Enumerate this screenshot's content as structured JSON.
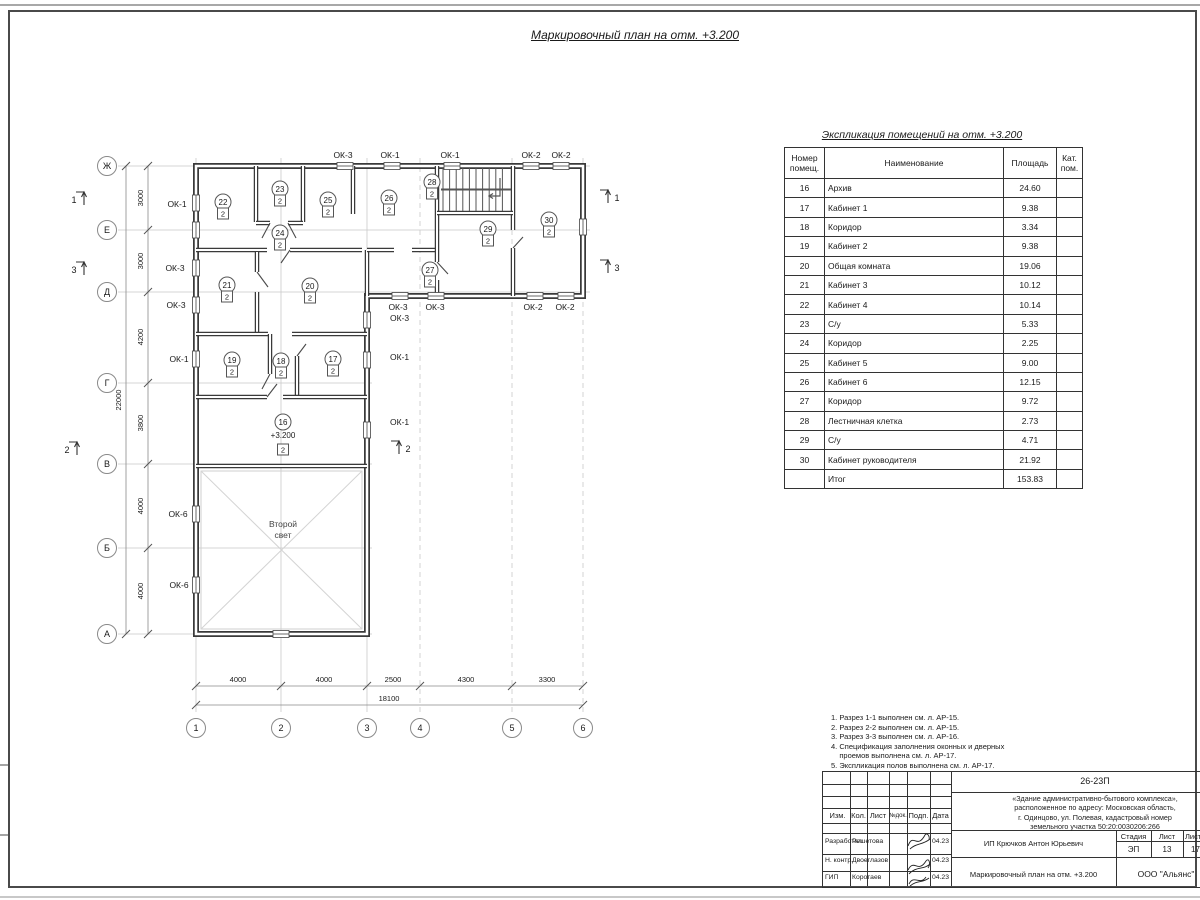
{
  "page": {
    "title": "Маркировочный план на отм. +3.200"
  },
  "schedule": {
    "title": "Экспликация помещений на отм. +3.200",
    "col_num": "Номер\nпомещ.",
    "col_name": "Наименование",
    "col_area": "Площадь",
    "col_cat": "Кат.\nпом.",
    "rows": [
      {
        "num": "16",
        "name": "Архив",
        "area": "24.60",
        "cat": ""
      },
      {
        "num": "17",
        "name": "Кабинет 1",
        "area": "9.38",
        "cat": ""
      },
      {
        "num": "18",
        "name": "Коридор",
        "area": "3.34",
        "cat": ""
      },
      {
        "num": "19",
        "name": "Кабинет 2",
        "area": "9.38",
        "cat": ""
      },
      {
        "num": "20",
        "name": "Общая комната",
        "area": "19.06",
        "cat": ""
      },
      {
        "num": "21",
        "name": "Кабинет 3",
        "area": "10.12",
        "cat": ""
      },
      {
        "num": "22",
        "name": "Кабинет 4",
        "area": "10.14",
        "cat": ""
      },
      {
        "num": "23",
        "name": "С/у",
        "area": "5.33",
        "cat": ""
      },
      {
        "num": "24",
        "name": "Коридор",
        "area": "2.25",
        "cat": ""
      },
      {
        "num": "25",
        "name": "Кабинет 5",
        "area": "9.00",
        "cat": ""
      },
      {
        "num": "26",
        "name": "Кабинет 6",
        "area": "12.15",
        "cat": ""
      },
      {
        "num": "27",
        "name": "Коридор",
        "area": "9.72",
        "cat": ""
      },
      {
        "num": "28",
        "name": "Лестничная клетка",
        "area": "2.73",
        "cat": ""
      },
      {
        "num": "29",
        "name": "С/у",
        "area": "4.71",
        "cat": ""
      },
      {
        "num": "30",
        "name": "Кабинет руководителя",
        "area": "21.92",
        "cat": ""
      }
    ],
    "total_label": "Итог",
    "total_area": "153.83"
  },
  "plan": {
    "elevation": "+3.200",
    "unit_mark": "2",
    "second_light": [
      "Второй",
      "свет"
    ],
    "axes_rows": [
      {
        "l": "Ж",
        "y": 166,
        "ext": 590
      },
      {
        "l": "Е",
        "y": 230,
        "ext": 590
      },
      {
        "l": "Д",
        "y": 292,
        "ext": 590
      },
      {
        "l": "Г",
        "y": 383,
        "ext": 372
      },
      {
        "l": "В",
        "y": 464,
        "ext": 372
      },
      {
        "l": "Б",
        "y": 548,
        "ext": 372
      },
      {
        "l": "А",
        "y": 634,
        "ext": 372
      }
    ],
    "axes_cols": [
      {
        "l": "1",
        "x": 196
      },
      {
        "l": "2",
        "x": 281
      },
      {
        "l": "3",
        "x": 367
      },
      {
        "l": "4",
        "x": 420
      },
      {
        "l": "5",
        "x": 512
      },
      {
        "l": "6",
        "x": 583
      }
    ],
    "dims_left": [
      {
        "t": "3000",
        "y": 198
      },
      {
        "t": "3000",
        "y": 261
      },
      {
        "t": "4200",
        "y": 337
      },
      {
        "t": "3800",
        "y": 423
      },
      {
        "t": "4000",
        "y": 506
      },
      {
        "t": "4000",
        "y": 591
      }
    ],
    "dim_left_total": {
      "t": "22000",
      "y": 400
    },
    "dims_bottom": [
      {
        "t": "4000",
        "x": 238
      },
      {
        "t": "4000",
        "x": 324
      },
      {
        "t": "2500",
        "x": 393
      },
      {
        "t": "4300",
        "x": 466
      },
      {
        "t": "3300",
        "x": 547
      }
    ],
    "dim_bottom_total": {
      "t": "18100",
      "x": 389
    },
    "window_labels": [
      {
        "t": "ОК-3",
        "x": 343,
        "y": 158
      },
      {
        "t": "ОК-1",
        "x": 390,
        "y": 158
      },
      {
        "t": "ОК-1",
        "x": 450,
        "y": 158
      },
      {
        "t": "ОК-2",
        "x": 531,
        "y": 158
      },
      {
        "t": "ОК-2",
        "x": 561,
        "y": 158
      },
      {
        "t": "ОК-1",
        "x": 177,
        "y": 207
      },
      {
        "t": "ОК-3",
        "x": 175,
        "y": 271
      },
      {
        "t": "ОК-3",
        "x": 176,
        "y": 308
      },
      {
        "t": "ОК-1",
        "x": 179,
        "y": 362
      },
      {
        "t": "ОК-6",
        "x": 178,
        "y": 517
      },
      {
        "t": "ОК-6",
        "x": 179,
        "y": 588
      },
      {
        "t": "ОК-3",
        "x": 390,
        "y": 321,
        "a": "start"
      },
      {
        "t": "ОК-1",
        "x": 390,
        "y": 360,
        "a": "start"
      },
      {
        "t": "ОК-1",
        "x": 390,
        "y": 425,
        "a": "start"
      },
      {
        "t": "ОК-3",
        "x": 398,
        "y": 310
      },
      {
        "t": "ОК-3",
        "x": 435,
        "y": 310
      },
      {
        "t": "ОК-2",
        "x": 533,
        "y": 310
      },
      {
        "t": "ОК-2",
        "x": 565,
        "y": 310
      }
    ],
    "rooms": [
      {
        "n": "16",
        "x": 283,
        "y": 422,
        "elev": true
      },
      {
        "n": "17",
        "x": 333,
        "y": 359
      },
      {
        "n": "18",
        "x": 281,
        "y": 361
      },
      {
        "n": "19",
        "x": 232,
        "y": 360
      },
      {
        "n": "20",
        "x": 310,
        "y": 286
      },
      {
        "n": "21",
        "x": 227,
        "y": 285
      },
      {
        "n": "22",
        "x": 223,
        "y": 202
      },
      {
        "n": "23",
        "x": 280,
        "y": 189
      },
      {
        "n": "24",
        "x": 280,
        "y": 233
      },
      {
        "n": "25",
        "x": 328,
        "y": 200
      },
      {
        "n": "26",
        "x": 389,
        "y": 198
      },
      {
        "n": "27",
        "x": 430,
        "y": 270
      },
      {
        "n": "28",
        "x": 432,
        "y": 182
      },
      {
        "n": "29",
        "x": 488,
        "y": 229
      },
      {
        "n": "30",
        "x": 549,
        "y": 220
      }
    ],
    "sections": [
      {
        "n": "1",
        "ax": 84,
        "ay": 188,
        "tx": 74,
        "ty": 203
      },
      {
        "n": "3",
        "ax": 84,
        "ay": 258,
        "tx": 74,
        "ty": 273
      },
      {
        "n": "2",
        "ax": 77,
        "ay": 438,
        "tx": 67,
        "ty": 453
      },
      {
        "n": "1",
        "ax": 608,
        "ay": 186,
        "tx": 617,
        "ty": 201
      },
      {
        "n": "3",
        "ax": 608,
        "ay": 256,
        "tx": 617,
        "ty": 271
      },
      {
        "n": "2",
        "ax": 399,
        "ay": 437,
        "tx": 408,
        "ty": 452
      }
    ]
  },
  "notes": [
    "1. Разрез 1-1 выполнен см. л. АР-15.",
    "2. Разрез 2-2 выполнен см. л. АР-15.",
    "3. Разрез 3-3 выполнен см. л. АР-16.",
    "4. Спецификация заполнения оконных и дверных",
    "    проемов выполнена см. л. АР-17.",
    "5. Экспликация полов выполнена см. л. АР-17."
  ],
  "stamp": {
    "doc_number": "26-23П",
    "project_lines": [
      "«Здание административно-бытового комплекса»,",
      "расположенное по адресу: Московская область,",
      "г. Одинцово, ул. Полевая, кадастровый номер",
      "земельного участка 50:20:0030206:266"
    ],
    "client": "ИП Крючков Антон Юрьевич",
    "sheet_title": "Маркировочный план на отм. +3.200",
    "company": "ООО \"Альянс\"",
    "stage_label": "Стадия",
    "sheet_label": "Лист",
    "sheets_label": "Листов",
    "stage": "ЭП",
    "sheet": "13",
    "sheets": "17",
    "cols": {
      "izm": "Изм.",
      "kol": "Кол.",
      "list": "Лист",
      "ndoc": "№док.",
      "podp": "Подп.",
      "data": "Дата"
    },
    "roles": [
      {
        "role": "Разработал",
        "name": "Решетова",
        "date": "04.23"
      },
      {
        "role": "Н. контр.",
        "name": "Двоеглазов",
        "date": "04.23"
      },
      {
        "role": "ГИП",
        "name": "Коротаев",
        "date": "04.23"
      }
    ]
  }
}
